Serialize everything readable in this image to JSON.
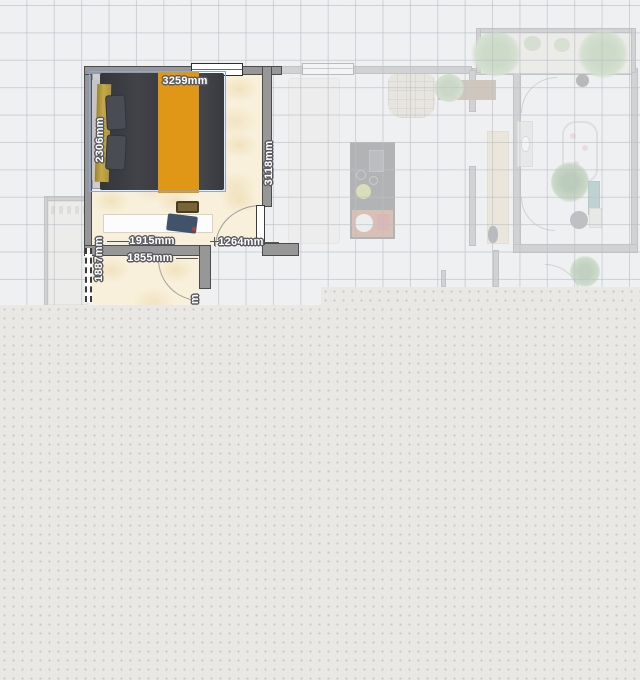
{
  "app": {
    "name": "floor-plan-editor",
    "view": "2d-floor-plan"
  },
  "colors": {
    "canvas_bg": "#eef0f2",
    "workspace_bg": "#e9e8e5",
    "grid_line": "#bcc0c7",
    "wall": "#979797",
    "active_floor": "#f8f0da",
    "bed_duvet": "#39393b",
    "bed_runner_accent": "#e5950b",
    "headboard_gold": "#c0a03a",
    "selection_border": "#85a9e0",
    "dimension_text": "#ffffff"
  },
  "plan": {
    "dimension_labels": {
      "bed_width": "3259mm",
      "bed_depth": "2306mm",
      "room_side": "3118mm",
      "wall_inner": "1915mm",
      "door_section": "1264mm",
      "wall_lower": "1855mm",
      "opening_side": "1887mm",
      "partial_cutoff": "m"
    }
  }
}
